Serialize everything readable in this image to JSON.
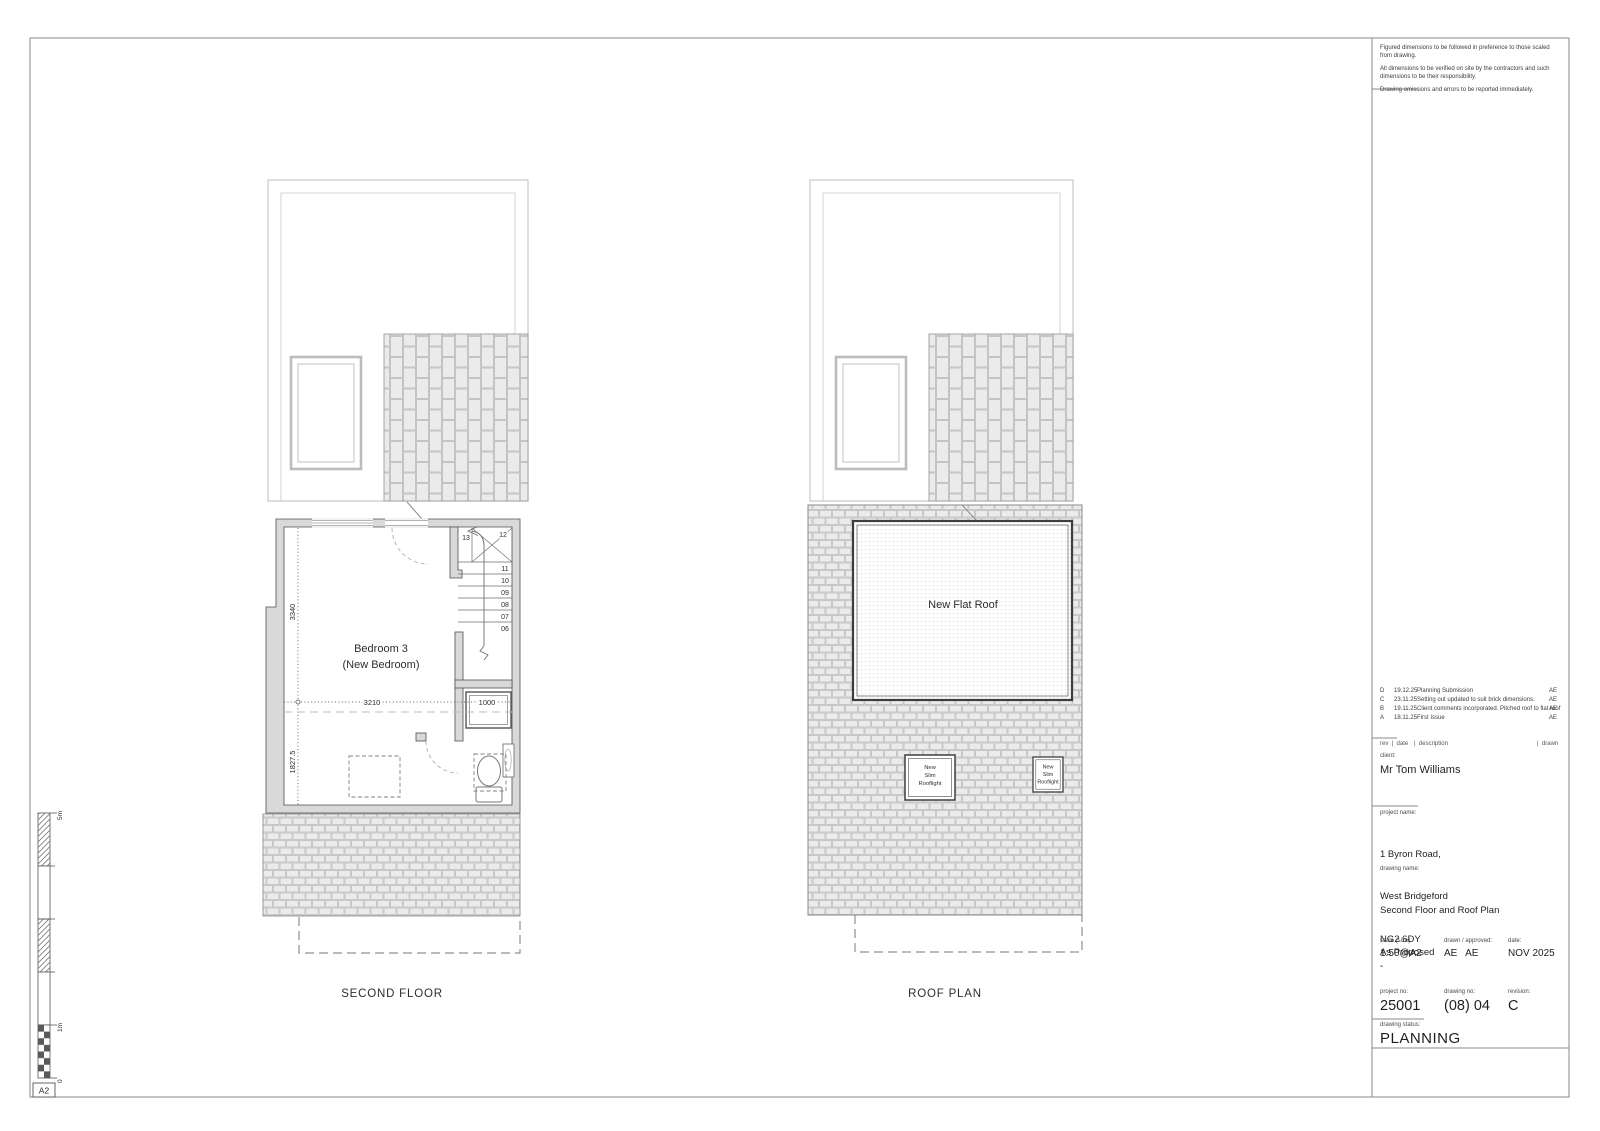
{
  "sheet": {
    "scale_bar": {
      "five_label": "5m",
      "one_label": "1m",
      "zero_label": "0",
      "paper_size": "A2"
    }
  },
  "plans": {
    "second_floor": {
      "title": "SECOND FLOOR",
      "room_line1": "Bedroom 3",
      "room_line2": "(New Bedroom)",
      "dims": {
        "width": "3210",
        "upper_height": "3340",
        "lower_height": "1827.5",
        "landing_width": "1000"
      },
      "stair_numbers": [
        "13",
        "12",
        "11",
        "10",
        "09",
        "08",
        "07",
        "06"
      ]
    },
    "roof": {
      "title": "ROOF PLAN",
      "flat_roof_label": "New Flat Roof",
      "rooflight_lines": [
        "New",
        "Slim",
        "Rooflight"
      ]
    }
  },
  "title_block": {
    "notes": [
      "Figured dimensions to be followed in preference to those scaled from drawing.",
      "All dimensions to be verified on site by the contractors and such dimensions to be their responsibility.",
      "Drawing omissions and errors to be reported immediately."
    ],
    "revisions": [
      {
        "rev": "D",
        "date": "19.12.25",
        "description": "Planning Submission",
        "drawn": "AE"
      },
      {
        "rev": "C",
        "date": "23.11.25",
        "description": "Setting out updated to suit brick dimensions.",
        "drawn": "AE"
      },
      {
        "rev": "B",
        "date": "19.11.25",
        "description": "Client comments incorporated. Pitched roof to flat roof",
        "drawn": "AE"
      },
      {
        "rev": "A",
        "date": "18.11.25",
        "description": "First Issue",
        "drawn": "AE"
      }
    ],
    "header": {
      "rev_date": "rev  |  date",
      "description": "|  description",
      "drawn": "|  drawn"
    },
    "client": {
      "label": "client:",
      "name": "Mr Tom Williams"
    },
    "project": {
      "label": "project name:",
      "line1": "1 Byron Road,",
      "line2": "West Bridgeford",
      "line3": "NG2 6DY"
    },
    "drawing": {
      "label": "drawing name:",
      "line1": "Second Floor and Roof Plan",
      "line2": "As Proposed"
    },
    "scale": {
      "label": "scale (size):",
      "value": "1:50@A2",
      "sub": "-"
    },
    "drawn_approved": {
      "label": "drawn / approved:",
      "value": "AE   AE"
    },
    "date": {
      "label": "date:",
      "value": "NOV 2025"
    },
    "project_no": {
      "label": "project no:",
      "value": "25001"
    },
    "drawing_no": {
      "label": "drawing no:",
      "value": "(08) 04"
    },
    "revision": {
      "label": "revision:",
      "value": "C"
    },
    "status": {
      "label": "drawing status:",
      "value": "PLANNING"
    }
  }
}
